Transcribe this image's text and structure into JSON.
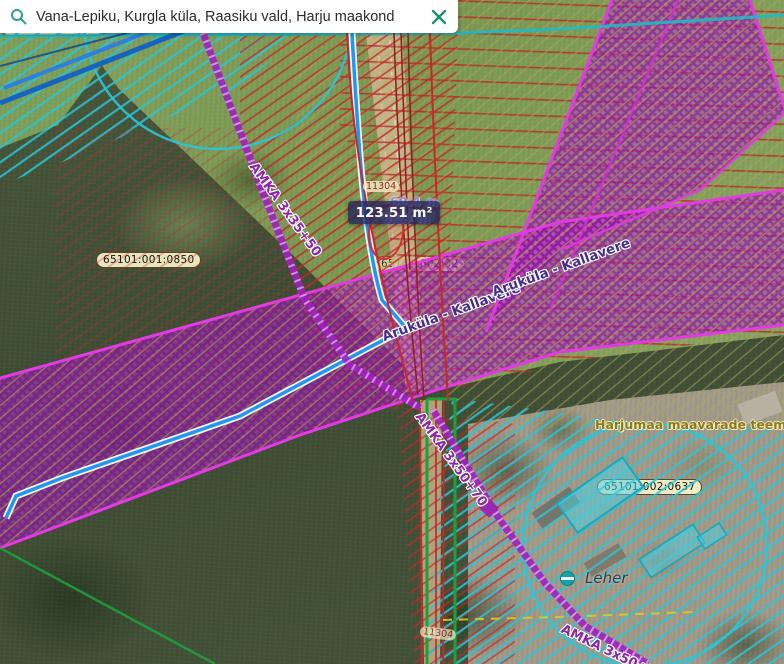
{
  "search_bar": {
    "query": "Vana-Lepiku, Kurgla küla, Raasiku vald, Harju maakond",
    "search_icon": "magnifier-icon",
    "close_icon": "x-icon"
  },
  "tooltip": {
    "area": "123.51 m²",
    "measure_width": "60.4 m",
    "measure_height": "8.27 m"
  },
  "cadastral": {
    "nw_clipped": "65101:001:0683",
    "west": "65101:001:0850",
    "southeast": "65101:002:0637",
    "center_faint": "65101:002:02"
  },
  "road": {
    "number": "11304",
    "names": [
      "Aruküla - Kallavere",
      "Aruküla - Kallavere"
    ]
  },
  "power_lines": {
    "nw": "AMKA 3x35+50",
    "center": "AMKA 3x50+70",
    "se": "AMKA 3x50+70"
  },
  "planning": {
    "label": "Harjumaa maavarade teemaplaneering"
  },
  "poi": {
    "name": "Leher"
  },
  "colors": {
    "corridor_magenta": "#c137c9",
    "corridor_border": "#e23be2",
    "restriction_red": "#c62828",
    "zone_cyan": "#26c6da",
    "stream_blue": "#2196f3",
    "boundary_green": "#1f9e3c",
    "cadastral_yellow": "#d9cb25",
    "powerline_purple": "#8e24aa",
    "roadname_purple": "#452d8a",
    "label_cream": "#faf2c6",
    "ui_teal": "#1b8e75"
  }
}
